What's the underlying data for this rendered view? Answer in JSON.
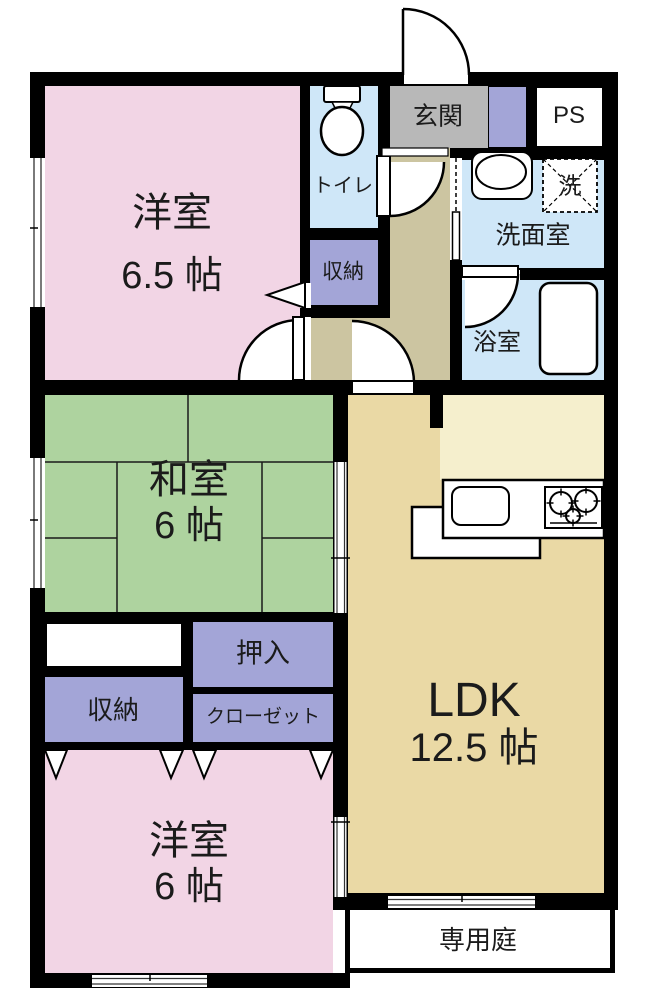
{
  "plan_type": "floorplan",
  "rooms": {
    "bedroom1": {
      "label": "洋室",
      "size": "6.5 帖"
    },
    "washitsu": {
      "label": "和室",
      "size": "6 帖"
    },
    "bedroom2": {
      "label": "洋室",
      "size": "6 帖"
    },
    "ldk": {
      "label": "LDK",
      "size": "12.5 帖"
    },
    "toilet": {
      "label": "トイレ"
    },
    "genkan": {
      "label": "玄関"
    },
    "ps": {
      "label": "PS"
    },
    "washroom": {
      "label": "洗面室"
    },
    "washer": {
      "label": "洗"
    },
    "bathroom": {
      "label": "浴室"
    },
    "storage_hall": {
      "label": "収納"
    },
    "storage_bedroom2": {
      "label": "収納"
    },
    "oshiire": {
      "label": "押入"
    },
    "closet": {
      "label": "クローゼット"
    },
    "garden": {
      "label": "専用庭"
    }
  },
  "icons": {
    "toilet": "toilet-icon",
    "sink": "sink-icon",
    "washing_machine": "washing-machine-icon",
    "bathtub": "bathtub-icon",
    "kitchen_sink": "kitchen-sink-icon",
    "stove": "stove-icon",
    "swing_door": "door-arc-icon",
    "folding_door": "triangle-door-icon",
    "sliding_door": "sliding-door-icon",
    "window": "window-icon"
  },
  "colors": {
    "wall": "#000000",
    "bedroom_pink": "#f2d5e5",
    "tatami_green": "#aed39f",
    "storage_purple": "#a3a5d7",
    "wet_area_blue": "#cfe7f8",
    "genkan_gray": "#b8b8b8",
    "hall_tan": "#ccc5a1",
    "ldk_tan": "#ead9a5",
    "kitchen_cream": "#f5efcd"
  }
}
